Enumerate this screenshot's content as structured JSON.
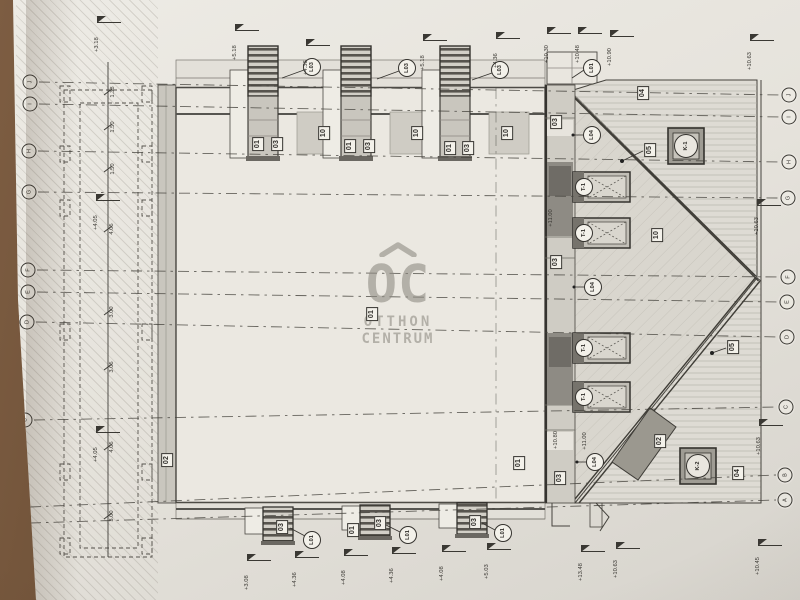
{
  "colors": {
    "paper": "#e6e3dc",
    "table_surface": "#6a4e37",
    "ink": "#3a3833",
    "roof_shade": "#d8d5cd",
    "dark_fill": "#9b988f",
    "watermark_gray": "#8f8b83"
  },
  "watermark": {
    "mark": "OC",
    "line2": "OTTHON",
    "line3": "CENTRUM"
  },
  "grid": {
    "left": [
      {
        "label": "J",
        "x": 30,
        "y": 82
      },
      {
        "label": "I",
        "x": 30,
        "y": 104
      },
      {
        "label": "H",
        "x": 29,
        "y": 151
      },
      {
        "label": "G",
        "x": 29,
        "y": 192
      },
      {
        "label": "F",
        "x": 28,
        "y": 270
      },
      {
        "label": "E",
        "x": 28,
        "y": 292
      },
      {
        "label": "D",
        "x": 27,
        "y": 322
      },
      {
        "label": "C",
        "x": 25,
        "y": 420
      },
      {
        "label": "B",
        "x": 21,
        "y": 507
      },
      {
        "label": "A",
        "x": 21,
        "y": 523
      }
    ],
    "right": [
      {
        "label": "J",
        "x": 789,
        "y": 95
      },
      {
        "label": "I",
        "x": 789,
        "y": 117
      },
      {
        "label": "H",
        "x": 789,
        "y": 162
      },
      {
        "label": "G",
        "x": 788,
        "y": 198
      },
      {
        "label": "F",
        "x": 788,
        "y": 277
      },
      {
        "label": "E",
        "x": 787,
        "y": 302
      },
      {
        "label": "D",
        "x": 787,
        "y": 337
      },
      {
        "label": "C",
        "x": 786,
        "y": 407
      },
      {
        "label": "B",
        "x": 785,
        "y": 475
      },
      {
        "label": "A",
        "x": 785,
        "y": 500
      }
    ]
  },
  "labels": {
    "boxed": [
      {
        "text": "01",
        "x": 258,
        "y": 144
      },
      {
        "text": "03",
        "x": 277,
        "y": 144
      },
      {
        "text": "10",
        "x": 324,
        "y": 133
      },
      {
        "text": "01",
        "x": 350,
        "y": 146
      },
      {
        "text": "03",
        "x": 369,
        "y": 146
      },
      {
        "text": "10",
        "x": 417,
        "y": 133
      },
      {
        "text": "01",
        "x": 450,
        "y": 148
      },
      {
        "text": "03",
        "x": 468,
        "y": 148
      },
      {
        "text": "10",
        "x": 507,
        "y": 133
      },
      {
        "text": "04",
        "x": 643,
        "y": 93
      },
      {
        "text": "05",
        "x": 650,
        "y": 150
      },
      {
        "text": "03",
        "x": 556,
        "y": 122
      },
      {
        "text": "10",
        "x": 657,
        "y": 235
      },
      {
        "text": "03",
        "x": 556,
        "y": 262
      },
      {
        "text": "01",
        "x": 372,
        "y": 314
      },
      {
        "text": "02",
        "x": 167,
        "y": 460
      },
      {
        "text": "01",
        "x": 519,
        "y": 463
      },
      {
        "text": "03",
        "x": 560,
        "y": 478
      },
      {
        "text": "02",
        "x": 660,
        "y": 441
      },
      {
        "text": "05",
        "x": 733,
        "y": 347
      },
      {
        "text": "04",
        "x": 738,
        "y": 473
      },
      {
        "text": "03",
        "x": 282,
        "y": 527
      },
      {
        "text": "01",
        "x": 353,
        "y": 530
      },
      {
        "text": "03",
        "x": 380,
        "y": 523
      },
      {
        "text": "03",
        "x": 475,
        "y": 522
      }
    ],
    "circled": [
      {
        "text": "L03",
        "x": 312,
        "y": 67,
        "kind": "circle"
      },
      {
        "text": "L03",
        "x": 407,
        "y": 68,
        "kind": "circle"
      },
      {
        "text": "L03",
        "x": 500,
        "y": 70,
        "kind": "circle"
      },
      {
        "text": "L01",
        "x": 592,
        "y": 68,
        "kind": "circle"
      },
      {
        "text": "L04",
        "x": 592,
        "y": 135,
        "kind": "circle"
      },
      {
        "text": "T-1",
        "x": 584,
        "y": 187,
        "kind": "circle"
      },
      {
        "text": "T-1",
        "x": 584,
        "y": 233,
        "kind": "circle"
      },
      {
        "text": "L04",
        "x": 593,
        "y": 287,
        "kind": "circle"
      },
      {
        "text": "T-1",
        "x": 584,
        "y": 348,
        "kind": "circle"
      },
      {
        "text": "T-1",
        "x": 584,
        "y": 397,
        "kind": "circle"
      },
      {
        "text": "L04",
        "x": 595,
        "y": 462,
        "kind": "circle"
      },
      {
        "text": "K-1",
        "x": 686,
        "y": 146,
        "kind": "plain"
      },
      {
        "text": "K-2",
        "x": 698,
        "y": 466,
        "kind": "plain"
      },
      {
        "text": "L01",
        "x": 312,
        "y": 540,
        "kind": "circle"
      },
      {
        "text": "L01",
        "x": 408,
        "y": 535,
        "kind": "circle"
      },
      {
        "text": "L01",
        "x": 503,
        "y": 533,
        "kind": "circle"
      }
    ]
  },
  "elevation_markers": [
    {
      "text": "+3.18",
      "x": 97,
      "y": 22
    },
    {
      "text": "+5.18",
      "x": 235,
      "y": 30
    },
    {
      "text": "+4.36",
      "x": 306,
      "y": 45
    },
    {
      "text": "+5.18",
      "x": 423,
      "y": 40
    },
    {
      "text": "+4.36",
      "x": 496,
      "y": 38
    },
    {
      "text": "+10.30",
      "x": 547,
      "y": 33
    },
    {
      "text": "+10.48",
      "x": 578,
      "y": 33
    },
    {
      "text": "+10.90",
      "x": 610,
      "y": 36
    },
    {
      "text": "+10.63",
      "x": 750,
      "y": 40
    },
    {
      "text": "+4.05",
      "x": 96,
      "y": 200
    },
    {
      "text": "+4.05",
      "x": 96,
      "y": 432
    },
    {
      "text": "+10.63",
      "x": 757,
      "y": 205
    },
    {
      "text": "+10.63",
      "x": 759,
      "y": 425
    },
    {
      "text": "+3.08",
      "x": 247,
      "y": 560
    },
    {
      "text": "+4.36",
      "x": 295,
      "y": 557
    },
    {
      "text": "+4.08",
      "x": 344,
      "y": 555
    },
    {
      "text": "+4.36",
      "x": 392,
      "y": 553
    },
    {
      "text": "+4.08",
      "x": 442,
      "y": 551
    },
    {
      "text": "+5.03",
      "x": 487,
      "y": 549
    },
    {
      "text": "+13.48",
      "x": 581,
      "y": 551
    },
    {
      "text": "+10.63",
      "x": 616,
      "y": 548
    },
    {
      "text": "+10.45",
      "x": 758,
      "y": 545
    }
  ],
  "dimensions": [
    {
      "text": "1.38",
      "x": 113,
      "y": 92
    },
    {
      "text": "1.50",
      "x": 113,
      "y": 127
    },
    {
      "text": "1.50",
      "x": 113,
      "y": 169
    },
    {
      "text": "4.05",
      "x": 112,
      "y": 229
    },
    {
      "text": "3.00",
      "x": 112,
      "y": 312
    },
    {
      "text": "3.05",
      "x": 112,
      "y": 367
    },
    {
      "text": "4.05",
      "x": 112,
      "y": 447
    },
    {
      "text": "3.00",
      "x": 112,
      "y": 516
    },
    {
      "text": "+11.00",
      "x": 551,
      "y": 218
    },
    {
      "text": "+10.80",
      "x": 556,
      "y": 440
    },
    {
      "text": "+11.00",
      "x": 585,
      "y": 441
    }
  ]
}
